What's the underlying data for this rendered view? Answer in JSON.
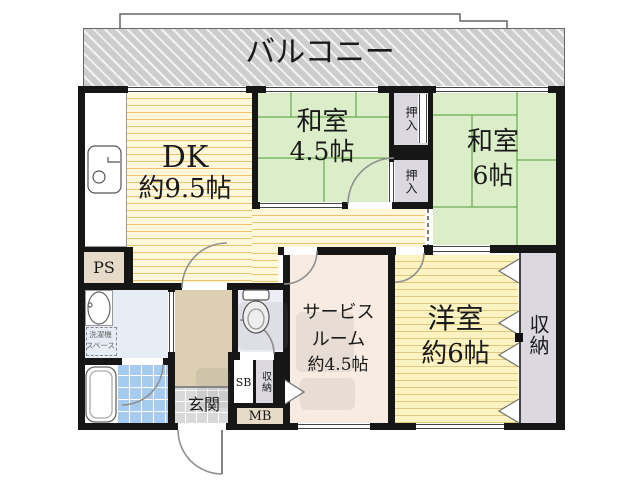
{
  "title": "apartment-floor-plan",
  "labels": {
    "balcony": "バルコニー",
    "dk_name": "DK",
    "dk_size": "約9.5帖",
    "washitsu_45_name": "和室",
    "washitsu_45_size": "4.5帖",
    "washitsu_6_name": "和室",
    "washitsu_6_size": "6帖",
    "oshiire_upper": "押入",
    "oshiire_lower": "押入",
    "yoshitsu_name": "洋室",
    "yoshitsu_size": "約6帖",
    "service_line1": "サービス",
    "service_line2": "ルーム",
    "service_line3": "約4.5帖",
    "closet_right": "収納",
    "closet_small": "収納",
    "ps": "PS",
    "sb": "SB",
    "mb": "MB",
    "genkan": "玄関",
    "washer_line1": "洗濯機",
    "washer_line2": "スペース"
  },
  "colors": {
    "wall": "#161616",
    "tatami_green": "#dcedca",
    "tatami_line": "#4e9a2e",
    "dk_floor": "#fdf8da",
    "dk_stripe": "#efc36e",
    "yoshitsu_floor": "#fcf3c2",
    "service_floor": "#f8ece2",
    "hall_floor": "#dccfb2",
    "closet_lavender": "#dbd8e2",
    "ps_beige": "#e6dbc8",
    "washroom_blue": "#e7edf5",
    "bath_tile_blue": "#a6cbf0",
    "genkan_gray": "#d9d9d9",
    "balcony_gray": "#cdcdcd"
  }
}
